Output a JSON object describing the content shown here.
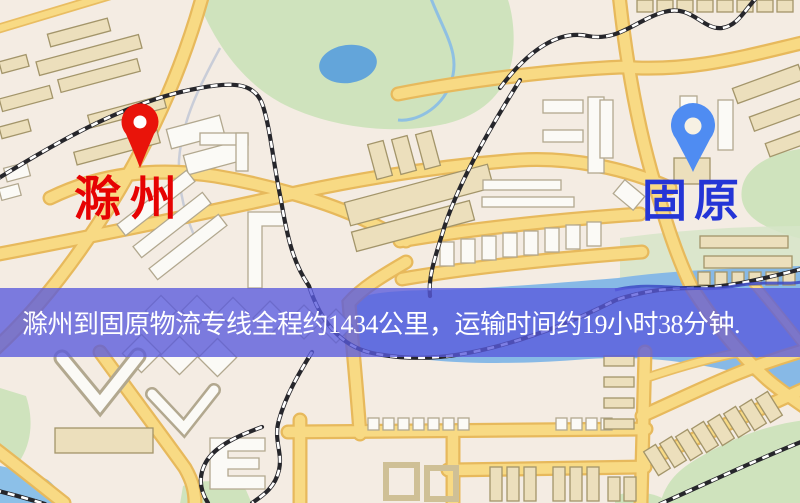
{
  "banner": {
    "text": "滁州到固原物流专线全程约1434公里，运输时间约19小时38分钟.",
    "background_color": "rgba(88,90,220,0.78)",
    "text_color": "#ffffff",
    "distance_km": "1434",
    "duration": "19小时38分钟"
  },
  "map": {
    "origin": {
      "label": "滁州",
      "pin_icon": "red-map-pin-icon",
      "pin_color": "#e9140a",
      "label_color": "#e60202"
    },
    "destination": {
      "label": "固原",
      "pin_icon": "blue-map-pin-icon",
      "pin_color": "#4f8cf2",
      "label_color": "#2435d6"
    }
  }
}
